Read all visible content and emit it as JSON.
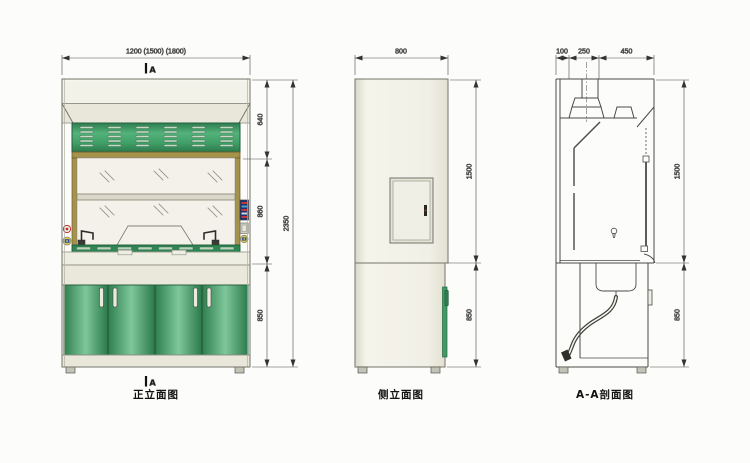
{
  "page": {
    "background": "#fcfcfa"
  },
  "views": {
    "front": {
      "title": "正立面图",
      "section_marker": "A",
      "dims": {
        "width": "1200 (1500) (1800)",
        "hood": "640",
        "sash": "860",
        "base": "850",
        "total": "2350"
      }
    },
    "side": {
      "title": "侧立面图",
      "dims": {
        "depth": "800",
        "upper": "1500",
        "base": "850"
      }
    },
    "section": {
      "title": "A-A剖面图",
      "dims": {
        "left": "100",
        "mid": "250",
        "right": "450",
        "upper": "1500",
        "base": "850"
      }
    }
  },
  "colors": {
    "door_green": "#3f9a63",
    "panel_green": "#3f9e66",
    "frame_tan": "#a5924b",
    "body_cream": "#f2f1e8",
    "line": "#4a4a48",
    "socket_yellow": "#e0cc42",
    "button_red": "#c23030",
    "display_blue": "#1c2f6e"
  }
}
